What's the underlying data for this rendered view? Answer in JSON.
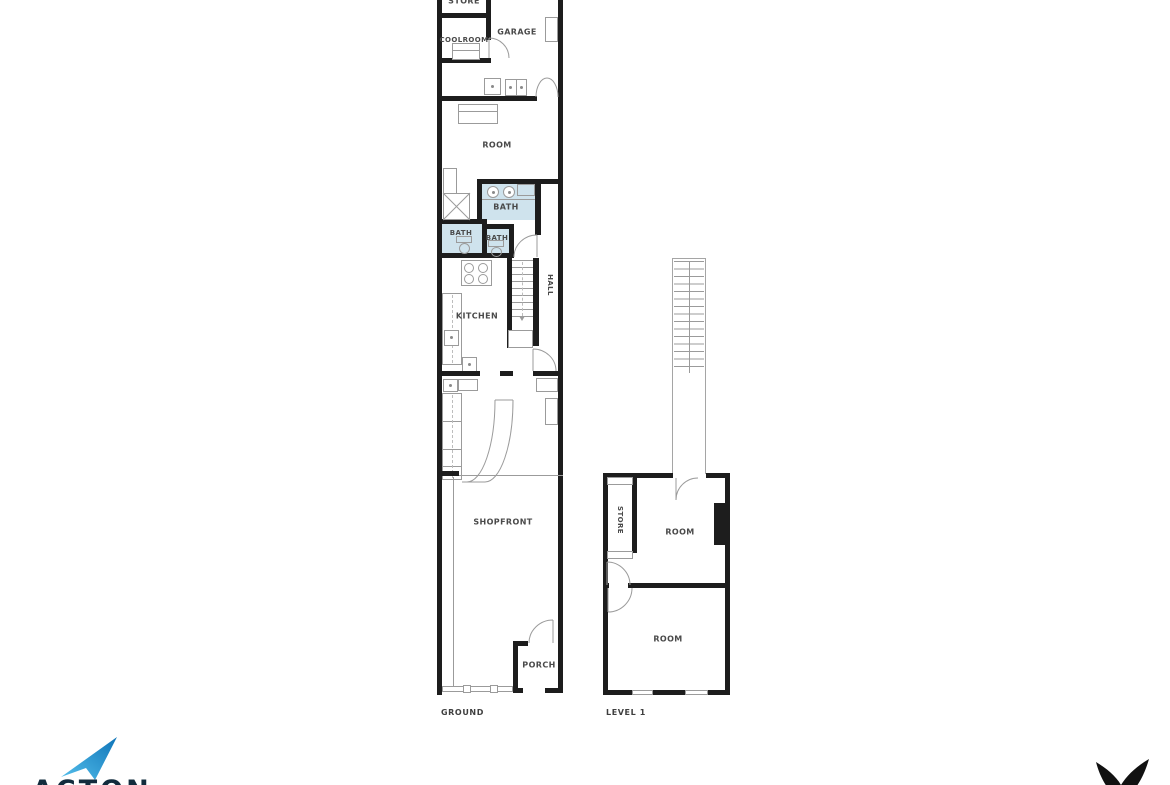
{
  "plans": {
    "ground": {
      "caption": "GROUND",
      "rooms": {
        "store": {
          "label": "STORE"
        },
        "coolroom": {
          "label": "COOLROOM"
        },
        "garage": {
          "label": "GARAGE"
        },
        "room": {
          "label": "ROOM"
        },
        "bath_main": {
          "label": "BATH"
        },
        "bath_small_left": {
          "label": "BATH"
        },
        "bath_small_right": {
          "label": "BATH"
        },
        "kitchen": {
          "label": "KITCHEN"
        },
        "hall": {
          "label": "HALL"
        },
        "shopfront": {
          "label": "SHOPFRONT"
        },
        "porch": {
          "label": "PORCH"
        }
      }
    },
    "level1": {
      "caption": "LEVEL 1",
      "rooms": {
        "store": {
          "label": "STORE"
        },
        "room_upper": {
          "label": "ROOM"
        },
        "room_lower": {
          "label": "ROOM"
        }
      }
    }
  },
  "branding": {
    "agency_name": "ACTON"
  },
  "colors": {
    "wall": "#1d1d1d",
    "bath_fill": "#cfe3ed",
    "fixture_line": "#9b9b9b",
    "label_text": "#4a4a4a",
    "logo_blue_light": "#55c0ec",
    "logo_blue_dark": "#0f74b8",
    "logo_navy": "#122c3d",
    "bird_black": "#111111"
  }
}
